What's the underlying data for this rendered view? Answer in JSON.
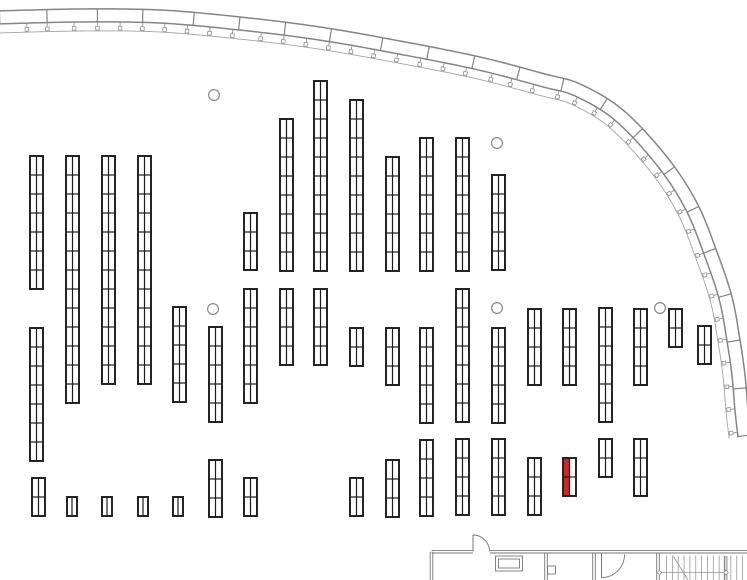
{
  "canvas": {
    "width": 747,
    "height": 580,
    "background": "#ffffff"
  },
  "colors": {
    "rack_stroke": "#1a1a1a",
    "rack_fill": "#ffffff",
    "highlight_red": "#d02626",
    "band_gray": "#858585",
    "thin_gray": "#a5a5a5",
    "tick_gray": "#919191",
    "column_gray": "#8a8a8a",
    "room_gray": "#777777",
    "stair_gray": "#999999"
  },
  "rack_defaults": {
    "width": 13,
    "bay_height": 19
  },
  "racks": [
    {
      "x": 30,
      "y": 156,
      "bays": 7
    },
    {
      "x": 66,
      "y": 156,
      "bays": 13
    },
    {
      "x": 102,
      "y": 156,
      "bays": 12
    },
    {
      "x": 138,
      "y": 156,
      "bays": 12
    },
    {
      "x": 244,
      "y": 213,
      "bays": 3
    },
    {
      "x": 280,
      "y": 119,
      "bays": 8
    },
    {
      "x": 314,
      "y": 81,
      "bays": 10
    },
    {
      "x": 350,
      "y": 100,
      "bays": 9
    },
    {
      "x": 386,
      "y": 157,
      "bays": 6
    },
    {
      "x": 420,
      "y": 138,
      "bays": 7
    },
    {
      "x": 456,
      "y": 138,
      "bays": 7
    },
    {
      "x": 492,
      "y": 175,
      "bays": 5
    },
    {
      "x": 30,
      "y": 328,
      "bays": 7
    },
    {
      "x": 173,
      "y": 307,
      "bays": 5
    },
    {
      "x": 209,
      "y": 327,
      "bays": 5
    },
    {
      "x": 244,
      "y": 289,
      "bays": 6
    },
    {
      "x": 280,
      "y": 289,
      "bays": 4
    },
    {
      "x": 314,
      "y": 289,
      "bays": 4
    },
    {
      "x": 350,
      "y": 328,
      "bays": 2
    },
    {
      "x": 386,
      "y": 328,
      "bays": 3
    },
    {
      "x": 420,
      "y": 328,
      "bays": 5
    },
    {
      "x": 456,
      "y": 289,
      "bays": 7
    },
    {
      "x": 492,
      "y": 328,
      "bays": 5
    },
    {
      "x": 528,
      "y": 309,
      "bays": 4
    },
    {
      "x": 563,
      "y": 309,
      "bays": 4
    },
    {
      "x": 599,
      "y": 308,
      "bays": 6
    },
    {
      "x": 634,
      "y": 309,
      "bays": 4
    },
    {
      "x": 669,
      "y": 309,
      "bays": 2
    },
    {
      "x": 698,
      "y": 326,
      "bays": 2
    },
    {
      "x": 32,
      "y": 478,
      "bays": 2
    },
    {
      "x": 67,
      "y": 497,
      "bays": 1,
      "w": 10
    },
    {
      "x": 102,
      "y": 497,
      "bays": 1,
      "w": 10
    },
    {
      "x": 138,
      "y": 497,
      "bays": 1,
      "w": 10
    },
    {
      "x": 173,
      "y": 497,
      "bays": 1,
      "w": 10
    },
    {
      "x": 209,
      "y": 460,
      "bays": 3
    },
    {
      "x": 244,
      "y": 478,
      "bays": 2
    },
    {
      "x": 350,
      "y": 478,
      "bays": 2
    },
    {
      "x": 386,
      "y": 460,
      "bays": 3
    },
    {
      "x": 420,
      "y": 440,
      "bays": 4
    },
    {
      "x": 456,
      "y": 439,
      "bays": 4
    },
    {
      "x": 492,
      "y": 439,
      "bays": 4
    },
    {
      "x": 528,
      "y": 458,
      "bays": 3
    },
    {
      "x": 563,
      "y": 458,
      "bays": 2,
      "highlight": "left"
    },
    {
      "x": 599,
      "y": 439,
      "bays": 2
    },
    {
      "x": 634,
      "y": 439,
      "bays": 3
    }
  ],
  "columns": {
    "radius": 5.4,
    "centers": [
      [
        214,
        95
      ],
      [
        497,
        143
      ],
      [
        213,
        309
      ],
      [
        497,
        308
      ],
      [
        660,
        308
      ]
    ]
  },
  "wall_band": {
    "outer_points": [
      [
        -4,
        11
      ],
      [
        80,
        9
      ],
      [
        160,
        10
      ],
      [
        240,
        17
      ],
      [
        320,
        27
      ],
      [
        400,
        41
      ],
      [
        480,
        57
      ],
      [
        545,
        74
      ],
      [
        580,
        84
      ],
      [
        623,
        110
      ],
      [
        667,
        157
      ],
      [
        697,
        203
      ],
      [
        717,
        252
      ],
      [
        732,
        297
      ],
      [
        740,
        340
      ],
      [
        745,
        375
      ],
      [
        748,
        410
      ],
      [
        751,
        436
      ]
    ],
    "band_offset": 13,
    "thin_offset": 22,
    "joint_spacing": 47.5,
    "joint_start": 3,
    "tick_spacing": 23.7,
    "tick_start": 25,
    "tick_square": 3.6
  },
  "rooms": {
    "double_gap": 2.6,
    "double_walls": [
      [
        431.5,
        551.7,
        473,
        551.7
      ],
      [
        490,
        551.7,
        747,
        551.7
      ],
      [
        431.5,
        551.7,
        431.5,
        580
      ],
      [
        546,
        553,
        546,
        580
      ],
      [
        594,
        553,
        594,
        580
      ],
      [
        658,
        553.5,
        658,
        580
      ],
      [
        725.6,
        556,
        725.6,
        580
      ]
    ],
    "doors": [
      {
        "leaf": [
          473,
          551.5,
          473,
          535
        ],
        "arc": "M 473,535 A 16.5,16.5 0 0 1 489.5,551.5"
      },
      {
        "leaf": [
          601.5,
          552.5,
          601.5,
          577.5
        ],
        "arc": "M 624.5,554.5 A 23,23 0 0 1 601.5,577.5"
      }
    ],
    "counter_rects": [
      [
        495.5,
        556,
        27,
        15
      ],
      [
        498.5,
        559,
        21,
        9
      ]
    ],
    "stub_rect": [
      547.5,
      566,
      8,
      8
    ]
  },
  "stairs": {
    "tread_y1": 555.5,
    "tread_y2": 580,
    "tread_start": 666.5,
    "tread_step": 5.85,
    "tread_end": 744.5,
    "direction_line": {
      "y": 572.5,
      "x1": 659.5,
      "x2": 726,
      "diamond": 2.3
    },
    "diagonal": [
      673.5,
      556.5,
      688,
      580
    ]
  }
}
